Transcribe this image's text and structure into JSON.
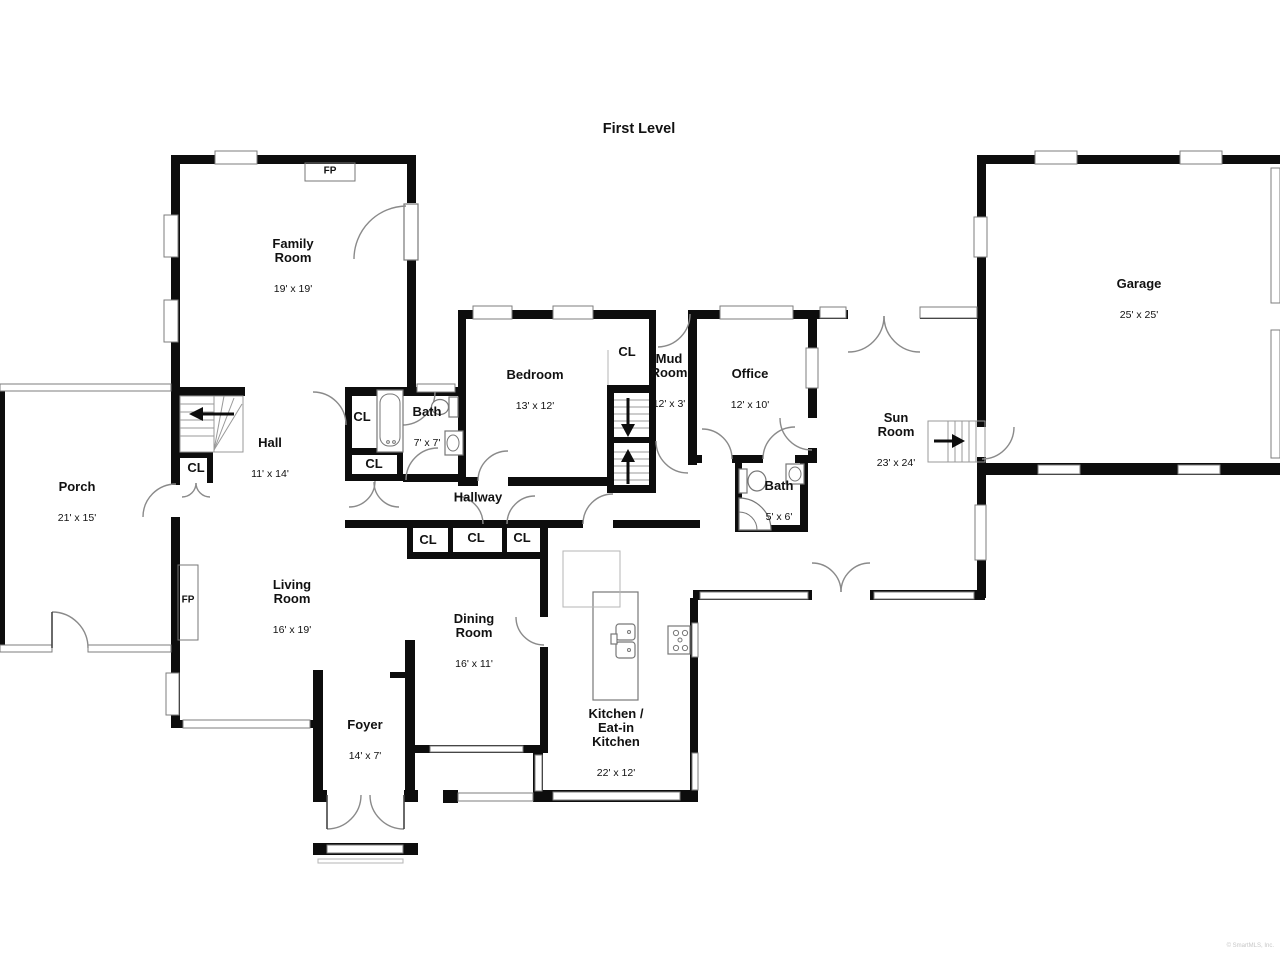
{
  "title": "First Level",
  "copyright": "© SmartMLS, Inc.",
  "labels": {
    "closet": "CL",
    "fireplace": "FP"
  },
  "rooms": {
    "family": {
      "name": "Family\nRoom",
      "dims": "19' x 19'"
    },
    "garage": {
      "name": "Garage",
      "dims": "25' x 25'"
    },
    "porch": {
      "name": "Porch",
      "dims": "21' x 15'"
    },
    "hall": {
      "name": "Hall",
      "dims": "11' x 14'"
    },
    "bath7": {
      "name": "Bath",
      "dims": "7' x 7'"
    },
    "bedroom": {
      "name": "Bedroom",
      "dims": "13' x 12'"
    },
    "mudroom": {
      "name": "Mud\nRoom",
      "dims": "12' x 3'"
    },
    "office": {
      "name": "Office",
      "dims": "12' x 10'"
    },
    "sunroom": {
      "name": "Sun\nRoom",
      "dims": "23' x 24'"
    },
    "bath5": {
      "name": "Bath",
      "dims": "5' x 6'"
    },
    "hallway": {
      "name": "Hallway",
      "dims": ""
    },
    "living": {
      "name": "Living\nRoom",
      "dims": "16' x 19'"
    },
    "dining": {
      "name": "Dining\nRoom",
      "dims": "16' x 11'"
    },
    "foyer": {
      "name": "Foyer",
      "dims": "14' x 7'"
    },
    "kitchen": {
      "name": "Kitchen /\nEat-in\nKitchen",
      "dims": "22' x 12'"
    }
  }
}
